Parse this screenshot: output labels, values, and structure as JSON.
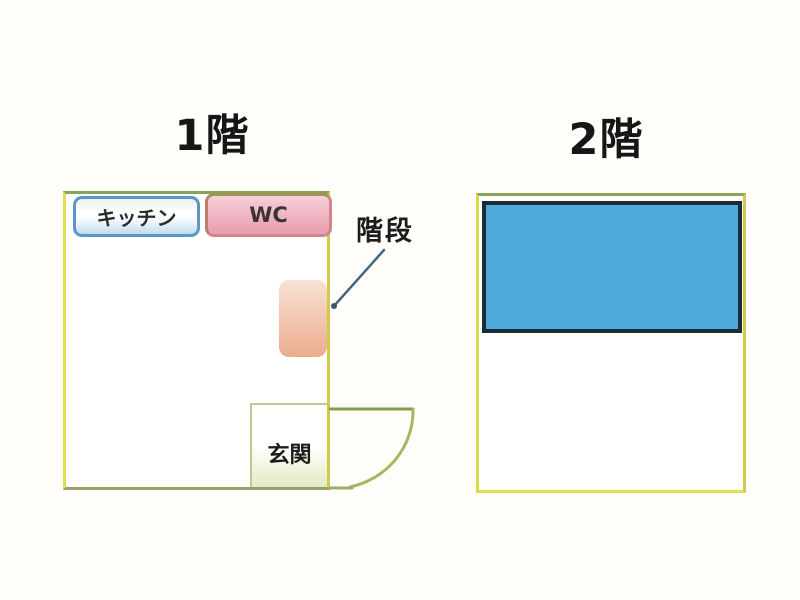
{
  "floors": {
    "floor1": {
      "title": "1階",
      "kitchen_label": "キッチン",
      "wc_label": "WC",
      "stairs_label": "階段",
      "entrance_label": "玄関",
      "colors": {
        "outline": "#d6d44f",
        "kitchen_border": "#5e95c5",
        "kitchen_fill": "#bedcef",
        "wc_border": "#cf8691",
        "wc_fill": "#ea9dad",
        "stairs_fill": "#e9ad8e",
        "entrance_line": "#b8cc90",
        "door_arc": "#9cb25c",
        "callout_line": "#44687e"
      }
    },
    "floor2": {
      "title": "2階",
      "colors": {
        "outline": "#d6d44f",
        "room_fill": "#4fa9da",
        "room_border": "#1c2b38"
      }
    }
  }
}
